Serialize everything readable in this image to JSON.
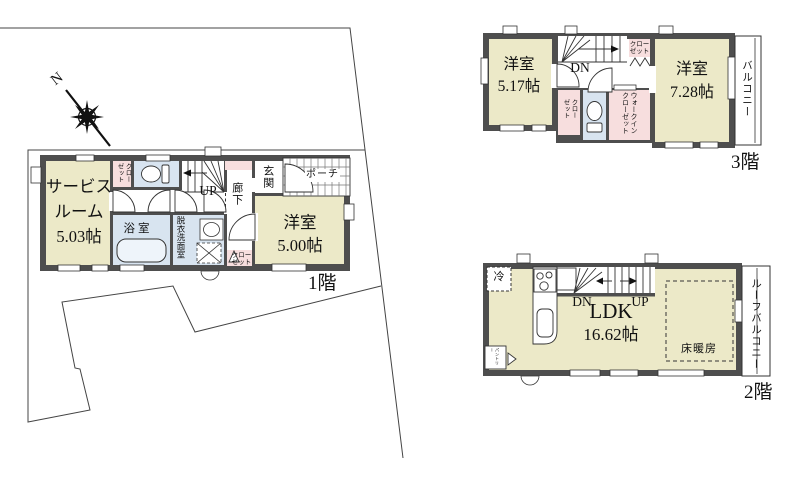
{
  "compass": {
    "north": "N"
  },
  "floors": {
    "f1": {
      "label": "1階",
      "service_room_line1": "サービス",
      "service_room_line2": "ルーム",
      "service_room_size": "5.03帖",
      "western_room": "洋室",
      "western_room_size": "5.00帖",
      "bathroom": "浴室",
      "washroom": "脱衣洗面室",
      "hallway": "廊下",
      "entrance": "玄関",
      "porch": "ポーチ",
      "closet_top": "クローゼット",
      "closet_bottom": "クローゼット",
      "stairs": "UP"
    },
    "f2": {
      "label": "2階",
      "ldk": "LDK",
      "ldk_size": "16.62帖",
      "floor_heating": "床暖房",
      "roof_balcony": "ルーフバルコニー",
      "refrigerator": "冷",
      "pantry": "パントリー",
      "stairs_down": "DN",
      "stairs_up": "UP"
    },
    "f3": {
      "label": "3階",
      "western_room_left": "洋室",
      "western_room_left_size": "5.17帖",
      "western_room_right": "洋室",
      "western_room_right_size": "7.28帖",
      "balcony": "バルコニー",
      "closet_top": "クローゼット",
      "closet_side": "クローゼット",
      "walk_in_closet": "ウォークインクローゼット",
      "stairs_down": "DN"
    }
  },
  "colors": {
    "wall": "#4e4e4e",
    "room_beige": "#ece9c8",
    "closet_pink": "#f7dede",
    "water_blue": "#d8e4f0",
    "line": "#333333"
  }
}
